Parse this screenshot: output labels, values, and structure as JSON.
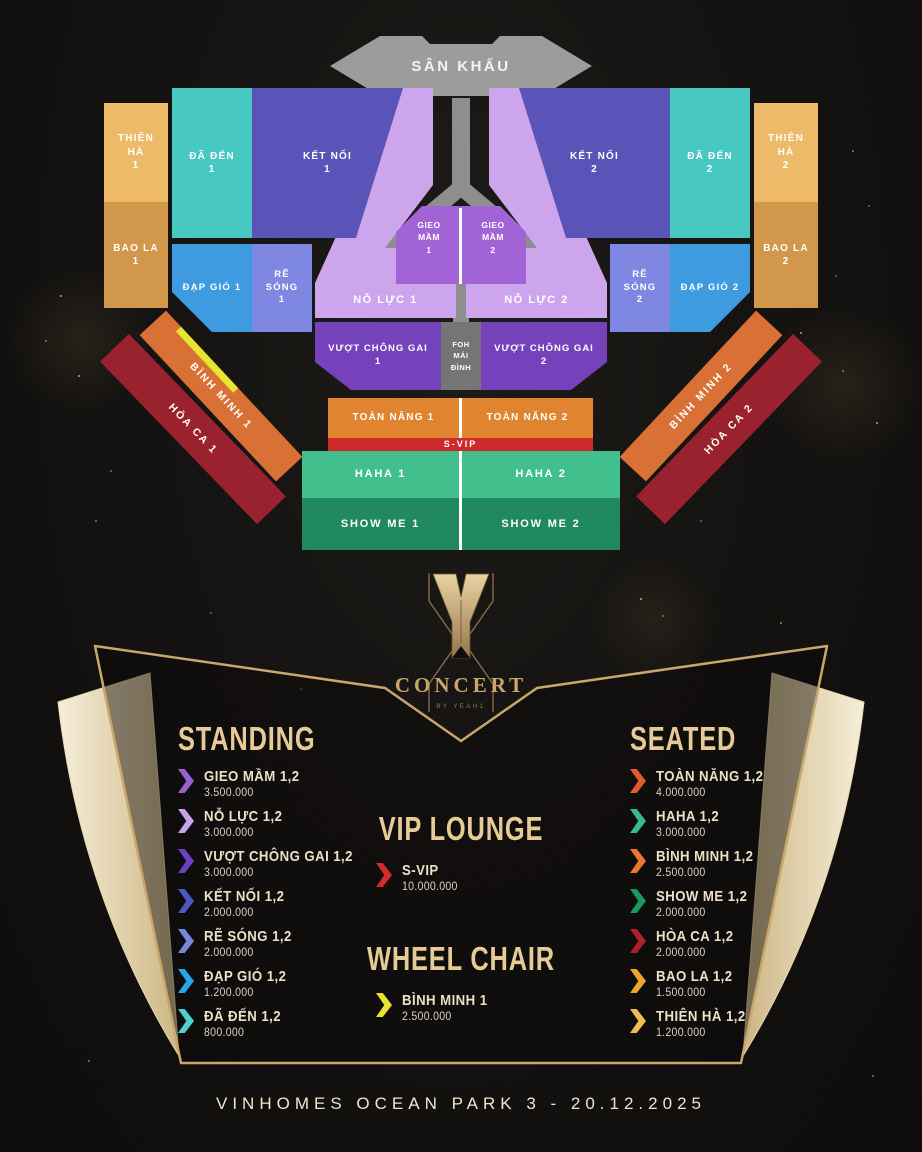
{
  "event": {
    "logo_title": "CONCERT",
    "logo_subtitle": "BY YEAH1",
    "venue_date": "VINHOMES OCEAN PARK 3 - 20.12.2025"
  },
  "map": {
    "stage_label": "SÂN KHẤU",
    "foh": {
      "lines": [
        "FOH",
        "MÁI",
        "ĐÌNH"
      ]
    },
    "wheelchair_stripe_color": "#e6e52f",
    "sections": {
      "thien_ha_1": {
        "label": "THIÊN HÀ 1",
        "lines": [
          "THIÊN",
          "HÀ",
          "1"
        ],
        "color": "#ecba69"
      },
      "bao_la_1": {
        "label": "BAO LA 1",
        "lines": [
          "BAO LA",
          "1"
        ],
        "color": "#d1974b"
      },
      "da_den_1": {
        "label": "ĐÃ ĐẾN 1",
        "lines": [
          "ĐÃ ĐẾN",
          "1"
        ],
        "color": "#48c8c3"
      },
      "ket_noi_1": {
        "label": "KẾT NỐI 1",
        "lines": [
          "KẾT NỐI",
          "1"
        ],
        "color": "#5a54b8"
      },
      "dap_gio_1": {
        "label": "ĐẠP GIÓ 1",
        "color": "#3e9bdf"
      },
      "re_song_1": {
        "label": "RẼ SÓNG 1",
        "lines": [
          "RẼ",
          "SÓNG",
          "1"
        ],
        "color": "#7e87e1"
      },
      "no_luc_1": {
        "label": "NỖ LỰC 1",
        "color": "#cda5ec"
      },
      "gieo_mam_1": {
        "label": "GIEO MẦM 1",
        "lines": [
          "GIEO",
          "MẦM",
          "1"
        ],
        "color": "#a263d6"
      },
      "gieo_mam_2": {
        "label": "GIEO MẦM 2",
        "lines": [
          "GIEO",
          "MẦM",
          "2"
        ],
        "color": "#a263d6"
      },
      "no_luc_2": {
        "label": "NỖ LỰC 2",
        "color": "#cda5ec"
      },
      "ket_noi_2": {
        "label": "KẾT NỐI 2",
        "lines": [
          "KẾT NỐI",
          "2"
        ],
        "color": "#5a54b8"
      },
      "da_den_2": {
        "label": "ĐÃ ĐẾN 2",
        "lines": [
          "ĐÃ ĐẾN",
          "2"
        ],
        "color": "#48c8c3"
      },
      "thien_ha_2": {
        "label": "THIÊN HÀ 2",
        "lines": [
          "THIÊN",
          "HÀ",
          "2"
        ],
        "color": "#ecba69"
      },
      "bao_la_2": {
        "label": "BAO LA 2",
        "lines": [
          "BAO LA",
          "2"
        ],
        "color": "#d1974b"
      },
      "re_song_2": {
        "label": "RẼ SÓNG 2",
        "lines": [
          "RẼ",
          "SÓNG",
          "2"
        ],
        "color": "#7e87e1"
      },
      "dap_gio_2": {
        "label": "ĐẠP GIÓ 2",
        "color": "#3e9bdf"
      },
      "vuot_chong_gai_1": {
        "label": "VƯỢT CHÔNG GAI 1",
        "lines": [
          "VƯỢT CHÔNG GAI",
          "1"
        ],
        "color": "#7642bc"
      },
      "vuot_chong_gai_2": {
        "label": "VƯỢT CHÔNG GAI 2",
        "lines": [
          "VƯỢT CHÔNG GAI",
          "2"
        ],
        "color": "#7642bc"
      },
      "foh_mai_dinh": {
        "label": "FOH MÁI ĐÌNH",
        "color": "#757575"
      },
      "binh_minh_1": {
        "label": "BÌNH MINH 1",
        "color": "#d97036"
      },
      "hoa_ca_1": {
        "label": "HÒA CA 1",
        "color": "#9a222f"
      },
      "binh_minh_2": {
        "label": "BÌNH MINH 2",
        "color": "#d97036"
      },
      "hoa_ca_2": {
        "label": "HÒA CA 2",
        "color": "#9a222f"
      },
      "toan_nang_1": {
        "label": "TOÀN NĂNG 1",
        "color": "#e08430"
      },
      "toan_nang_2": {
        "label": "TOÀN NĂNG 2",
        "color": "#e08430"
      },
      "s_vip": {
        "label": "S-VIP",
        "color": "#cd2b2b"
      },
      "haha_1": {
        "label": "HAHA 1",
        "color": "#41c08d"
      },
      "haha_2": {
        "label": "HAHA 2",
        "color": "#41c08d"
      },
      "show_me_1": {
        "label": "SHOW ME 1",
        "color": "#20895f"
      },
      "show_me_2": {
        "label": "SHOW ME 2",
        "color": "#20895f"
      }
    }
  },
  "legend": {
    "standing": {
      "heading": "STANDING",
      "items": [
        {
          "name": "GIEO MẦM 1,2",
          "price": "3.500.000",
          "color": "#9a5fd4"
        },
        {
          "name": "NỖ LỰC 1,2",
          "price": "3.000.000",
          "color": "#c9a3e8"
        },
        {
          "name": "VƯỢT CHÔNG GAI 1,2",
          "price": "3.000.000",
          "color": "#6c40c2"
        },
        {
          "name": "KẾT NỐI 1,2",
          "price": "2.000.000",
          "color": "#4f55c6"
        },
        {
          "name": "RẼ SÓNG 1,2",
          "price": "2.000.000",
          "color": "#7a85de"
        },
        {
          "name": "ĐẠP GIÓ 1,2",
          "price": "1.200.000",
          "color": "#27a7e8"
        },
        {
          "name": "ĐÃ ĐẾN 1,2",
          "price": "800.000",
          "color": "#4fd0ca"
        }
      ]
    },
    "vip_lounge": {
      "heading": "VIP LOUNGE",
      "items": [
        {
          "name": "S-VIP",
          "price": "10.000.000",
          "color": "#d62b2b"
        }
      ]
    },
    "wheel_chair": {
      "heading": "WHEEL CHAIR",
      "items": [
        {
          "name": "BÌNH MINH 1",
          "price": "2.500.000",
          "color": "#e8e431"
        }
      ]
    },
    "seated": {
      "heading": "SEATED",
      "items": [
        {
          "name": "TOÀN NĂNG 1,2",
          "price": "4.000.000",
          "color": "#e25b2b"
        },
        {
          "name": "HAHA 1,2",
          "price": "3.000.000",
          "color": "#38bb8f"
        },
        {
          "name": "BÌNH MINH 1,2",
          "price": "2.500.000",
          "color": "#ef7434"
        },
        {
          "name": "SHOW ME 1,2",
          "price": "2.000.000",
          "color": "#17995f"
        },
        {
          "name": "HÒA CA 1,2",
          "price": "2.000.000",
          "color": "#b01f2d"
        },
        {
          "name": "BAO LA 1,2",
          "price": "1.500.000",
          "color": "#f0a42e"
        },
        {
          "name": "THIÊN HÀ 1,2",
          "price": "1.200.000",
          "color": "#f0bc5a"
        }
      ]
    }
  },
  "theme": {
    "gold_line": "#c9a76a",
    "cream_wing": "#f0e6cd",
    "heading_color": "#e6cb97",
    "background": "#12100e"
  }
}
